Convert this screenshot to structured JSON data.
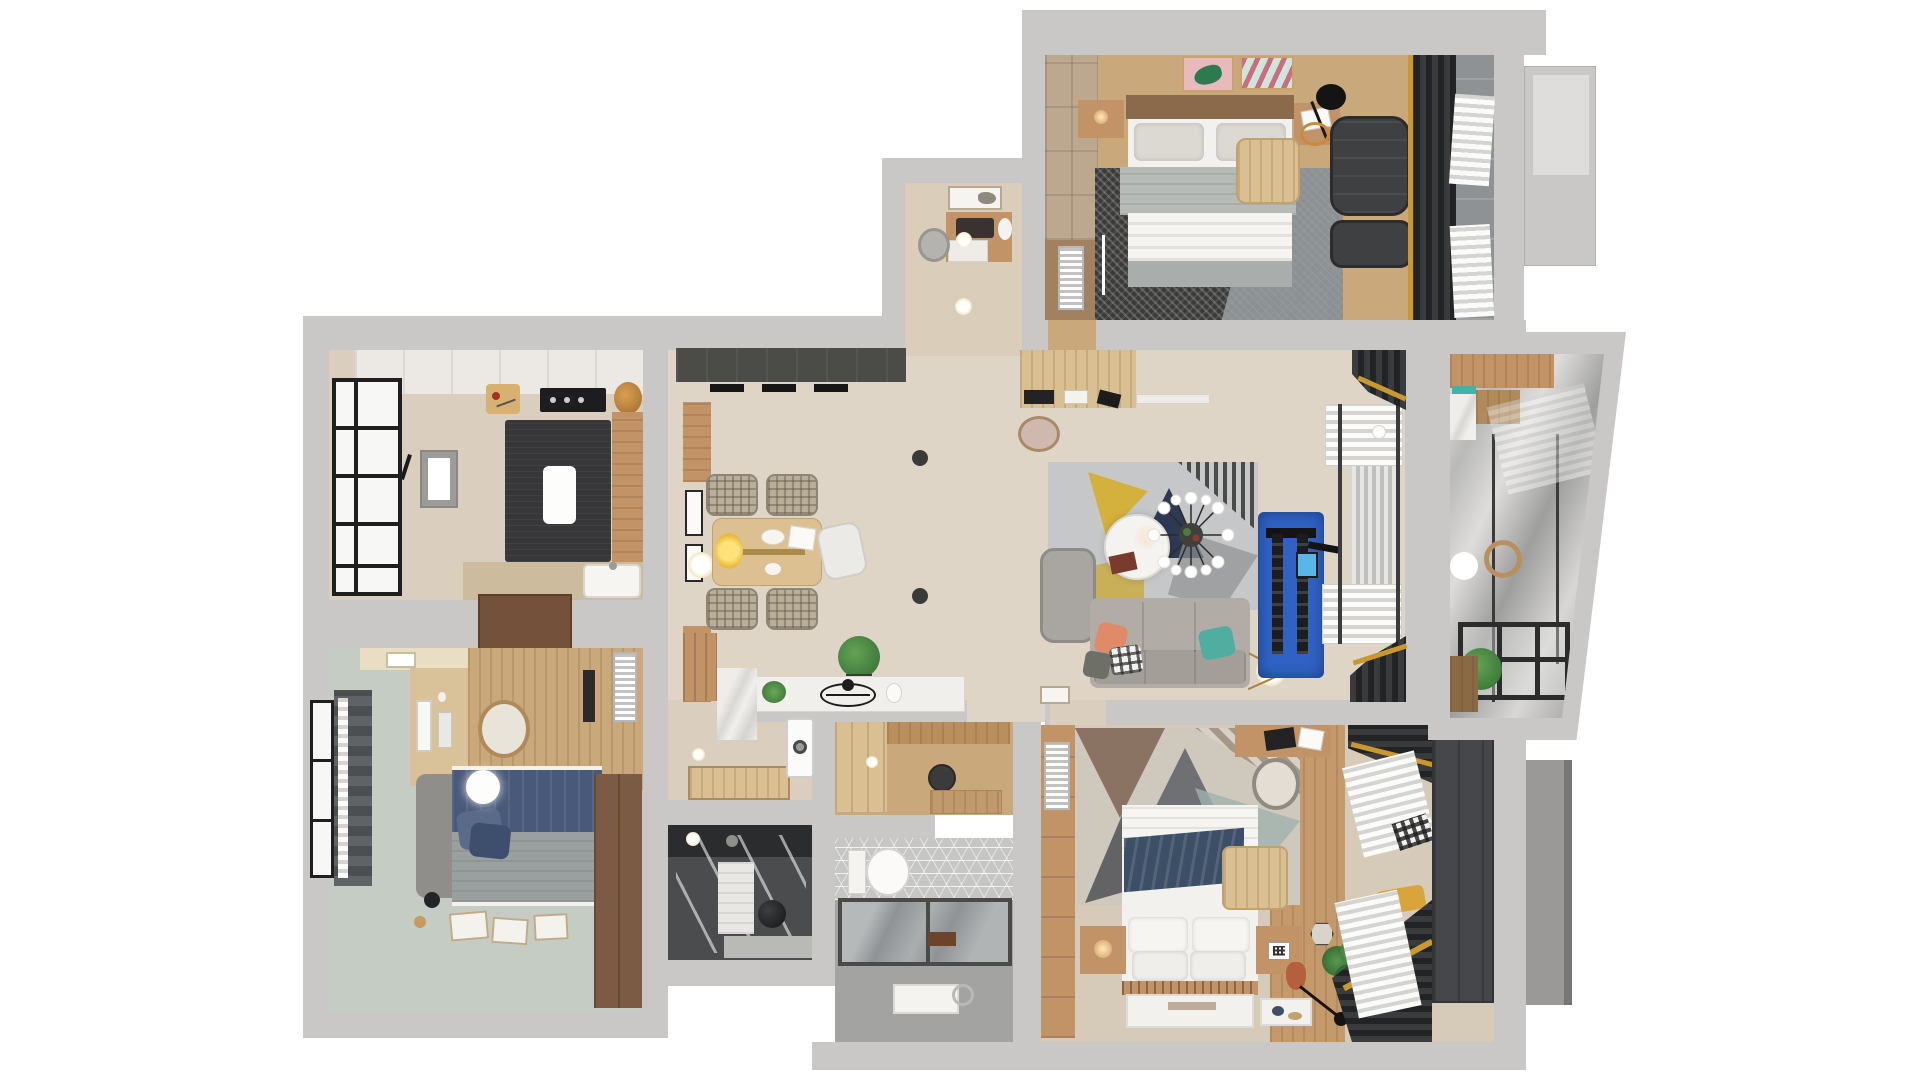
{
  "meta": {
    "type": "3d-floor-plan-render",
    "view": "top-down",
    "description": "Photorealistic 3D top view floor plan of a three-bedroom apartment with kitchen, dining-living area, two bathrooms, foyer and glazed balcony",
    "canvas": {
      "width": 1920,
      "height": 1080,
      "background": "#ffffff"
    }
  },
  "colors": {
    "wall": "#c9c8c6",
    "wall_dark": "#b1b0ae",
    "floor_cream": "#ded5c6",
    "floor_beige": "#dacfbe",
    "floor_sage": "#c5ccc3",
    "floor_wood": "#c9a87b",
    "wood_light": "#dabf92",
    "wood_tan": "#c19367",
    "wood_dark": "#8a6a4a",
    "wood_brown": "#74513a",
    "white_soft": "#f2f1ee",
    "island": "#37373a",
    "beam": "#4b4b47",
    "curtain": "#333435",
    "gold": "#c9992f",
    "navy": "#3d4f66",
    "blue": "#2f62c4",
    "teal": "#43b1a9",
    "orange": "#e08a67",
    "sofa": "#b1ada6",
    "rug_light": "#c6c7c9",
    "rug_dark": "#3a3a38",
    "tile_gray": "#a3a3a1",
    "glass": "#8f9395",
    "sage_dark": "#9fb3ad"
  },
  "rooms": [
    {
      "id": "kitchen",
      "name": "kitchen",
      "floor": "beige tile",
      "items": [
        "upper-cabinets",
        "cutting-board",
        "cooktop",
        "bread",
        "tall-cabinet",
        "dark-island",
        "island-light",
        "wall-tv-mirror",
        "wall-sconce",
        "counter",
        "sink",
        "framed-window",
        "open-brown-door"
      ]
    },
    {
      "id": "bedroom-2",
      "name": "bedroom with desk",
      "floor": "sage green",
      "items": [
        "cream-cabinet",
        "shelf-boxes",
        "wood-platform",
        "desk-with-monitor",
        "keyboard",
        "desk-chair",
        "ac-panel",
        "radiator",
        "double-bed-navy",
        "gray-headboard",
        "pillows",
        "pendant-lamp",
        "brown-wardrobe",
        "floor-papers",
        "floor-lamp",
        "curtained-window"
      ]
    },
    {
      "id": "vanity-room",
      "name": "small study / vanity room",
      "floor": "beige",
      "items": [
        "wall-art",
        "desk",
        "laptop",
        "flower-vase",
        "drawer",
        "pouf",
        "downlights"
      ]
    },
    {
      "id": "master-bedroom",
      "name": "master bedroom",
      "floor": "wood",
      "items": [
        "wardrobe-column",
        "lower-cabinet",
        "radiator",
        "woven-rug",
        "stone-rug",
        "double-bed",
        "wood-headboard",
        "pillows",
        "gray-blanket",
        "white-duvet",
        "nightstand-left",
        "nightstand-right",
        "open-book",
        "clothes-table",
        "arc-floor-lamp",
        "recliner-armchair",
        "ottoman",
        "wall-art-pink",
        "wall-art-mint",
        "dark-drapes",
        "sheer-curtains",
        "gray-tile-strip",
        "exterior-ac-ledge"
      ]
    },
    {
      "id": "dining-area",
      "name": "dining area",
      "floor": "cream",
      "items": [
        "charcoal-beam",
        "track-lights",
        "wood-wall-strips",
        "wall-frames",
        "wall-sconce",
        "dining-table",
        "brass-runner",
        "yellow-flowers",
        "plaid-chair-1",
        "plaid-chair-2",
        "plaid-chair-3",
        "plaid-chair-4",
        "white-chair",
        "ceiling-spots",
        "potted-plant",
        "sideboard",
        "wire-sculpture",
        "leaning-frame"
      ]
    },
    {
      "id": "living-area",
      "name": "living area",
      "floor": "cream",
      "items": [
        "wall-desk",
        "books",
        "bench-stool",
        "geometric-rug",
        "lounge-chair",
        "sofa",
        "pillow-orange",
        "pillow-plaid",
        "pillow-teal",
        "pillow-gray",
        "round-coffee-table",
        "red-book",
        "sputnik-chandelier",
        "tripod-lamp",
        "ball-lamp",
        "blue-gym-mat",
        "cable-machine",
        "machine-screen",
        "roman-shade-top",
        "roman-shade-bottom",
        "window-blinds",
        "dark-curtain-top",
        "dark-curtain-bottom"
      ]
    },
    {
      "id": "corridor",
      "name": "laundry corridor",
      "floor": "beige",
      "items": [
        "wood-wardrobe",
        "marble-floor",
        "wood-runner",
        "downlight",
        "washing-machine"
      ]
    },
    {
      "id": "foyer",
      "name": "entry foyer",
      "floor": "wood",
      "items": [
        "wardrobe",
        "wood-wall-band",
        "round-stool",
        "door-mat",
        "downlight"
      ]
    },
    {
      "id": "shower-room",
      "name": "dark shower room",
      "floor": "dark tile",
      "items": [
        "vanity-counter",
        "glass-partition",
        "towel-column",
        "black-sphere-stool",
        "step",
        "downlight"
      ]
    },
    {
      "id": "bathroom",
      "name": "main bathroom",
      "floor": "gray tile",
      "items": [
        "hex-tile-band",
        "toilet",
        "glass-shower-enclosure",
        "soap-shelf",
        "bath-mat",
        "shower-hose"
      ]
    },
    {
      "id": "bedroom-3",
      "name": "bedroom bottom-right",
      "floor": "cream + wood strip",
      "items": [
        "wardrobe-strip",
        "radiator",
        "triangle-rug",
        "double-bed",
        "navy-throw",
        "pillows",
        "slat-headboard",
        "bench-table",
        "nightstand-left",
        "lantern-lamp",
        "nightstand-right",
        "qr-frame",
        "terracotta-vase",
        "swing-floor-lamp",
        "hex-mirror",
        "potted-plant",
        "wall-desk",
        "desk-chair",
        "white-mats",
        "sheer-curtains",
        "dark-blinds",
        "dark-wardrobe",
        "yellow-cushion",
        "plaid-garment",
        "exterior-utility-box"
      ]
    },
    {
      "id": "balcony",
      "name": "glazed balcony",
      "floor": "reflective glass",
      "items": [
        "wood-cabinet-top",
        "teal-accent",
        "marble-counter",
        "wood-boxes",
        "glass-mullions",
        "round-mirror",
        "white-stool-light",
        "window-railing",
        "potted-plant",
        "wood-cabinet-bottom"
      ]
    }
  ]
}
